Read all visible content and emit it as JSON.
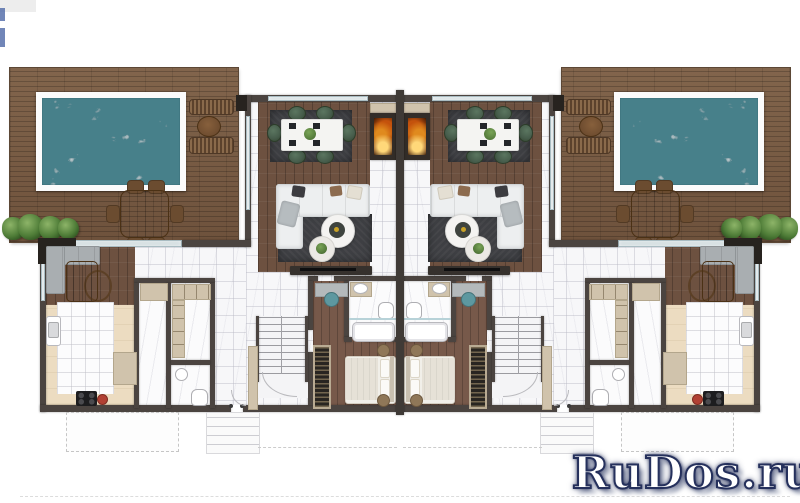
{
  "watermark": {
    "text": "RuDos.ru"
  },
  "palette": {
    "pool": "#47808a",
    "pool-deep": "#2f5f68",
    "deck": "#7c5f47",
    "wood": "#6d5140",
    "wood-light": "#77594a",
    "wall": "#4b4440",
    "wall-black": "#27231f",
    "marble": "#f7f7f9",
    "beige-floor": "#ecdcc1",
    "cabinet": "#d0c3ac",
    "rug": "#3e3f43",
    "sofa": "#edeff0",
    "chair-green": "#465c4b",
    "gray-sofa": "#a9aeb1",
    "fire-orange": "#e08a1e",
    "glass": "#d4dee1",
    "plant": "#4e7c37",
    "watermark-ink": "#25305c"
  }
}
